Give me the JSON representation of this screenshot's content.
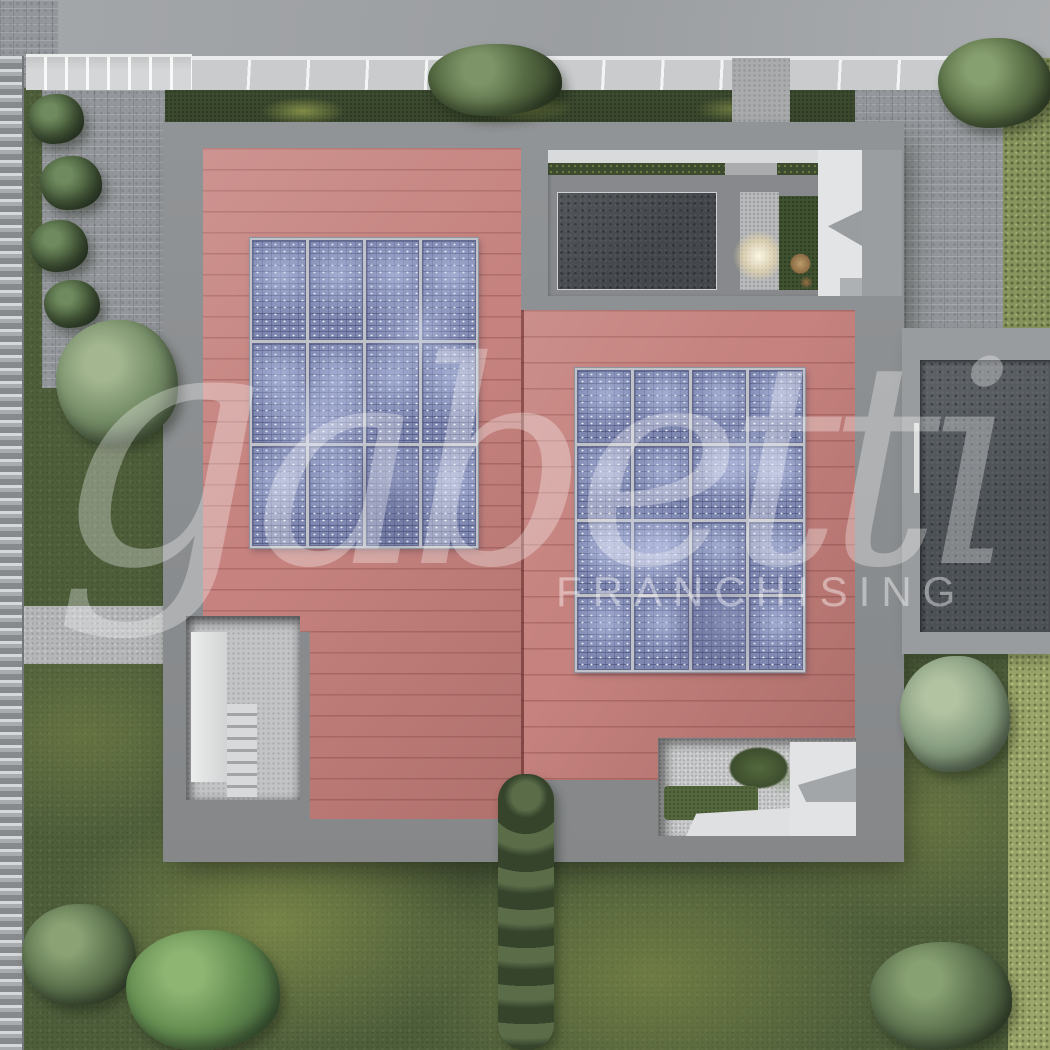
{
  "watermark": {
    "brand": "gabetti",
    "subtitle": "FRANCHISING"
  },
  "palette": {
    "roof_red": "#c5827e",
    "panel_blue": "#7e87b0",
    "grass_green": "#4e5e3b",
    "concrete_gray": "#8c8f91",
    "road_gray": "#9fa2a5",
    "terrace_dark": "#43474b",
    "wall_white": "#e3e4e5",
    "hedge_dark": "#3c4a2f",
    "meadow_olive": "#9aa569"
  },
  "solar": {
    "left_array": {
      "cols": 4,
      "rows": 3,
      "x": 250,
      "y": 238,
      "w": 228,
      "h": 310
    },
    "right_array": {
      "cols": 4,
      "rows": 4,
      "x": 575,
      "y": 368,
      "w": 230,
      "h": 304
    }
  }
}
